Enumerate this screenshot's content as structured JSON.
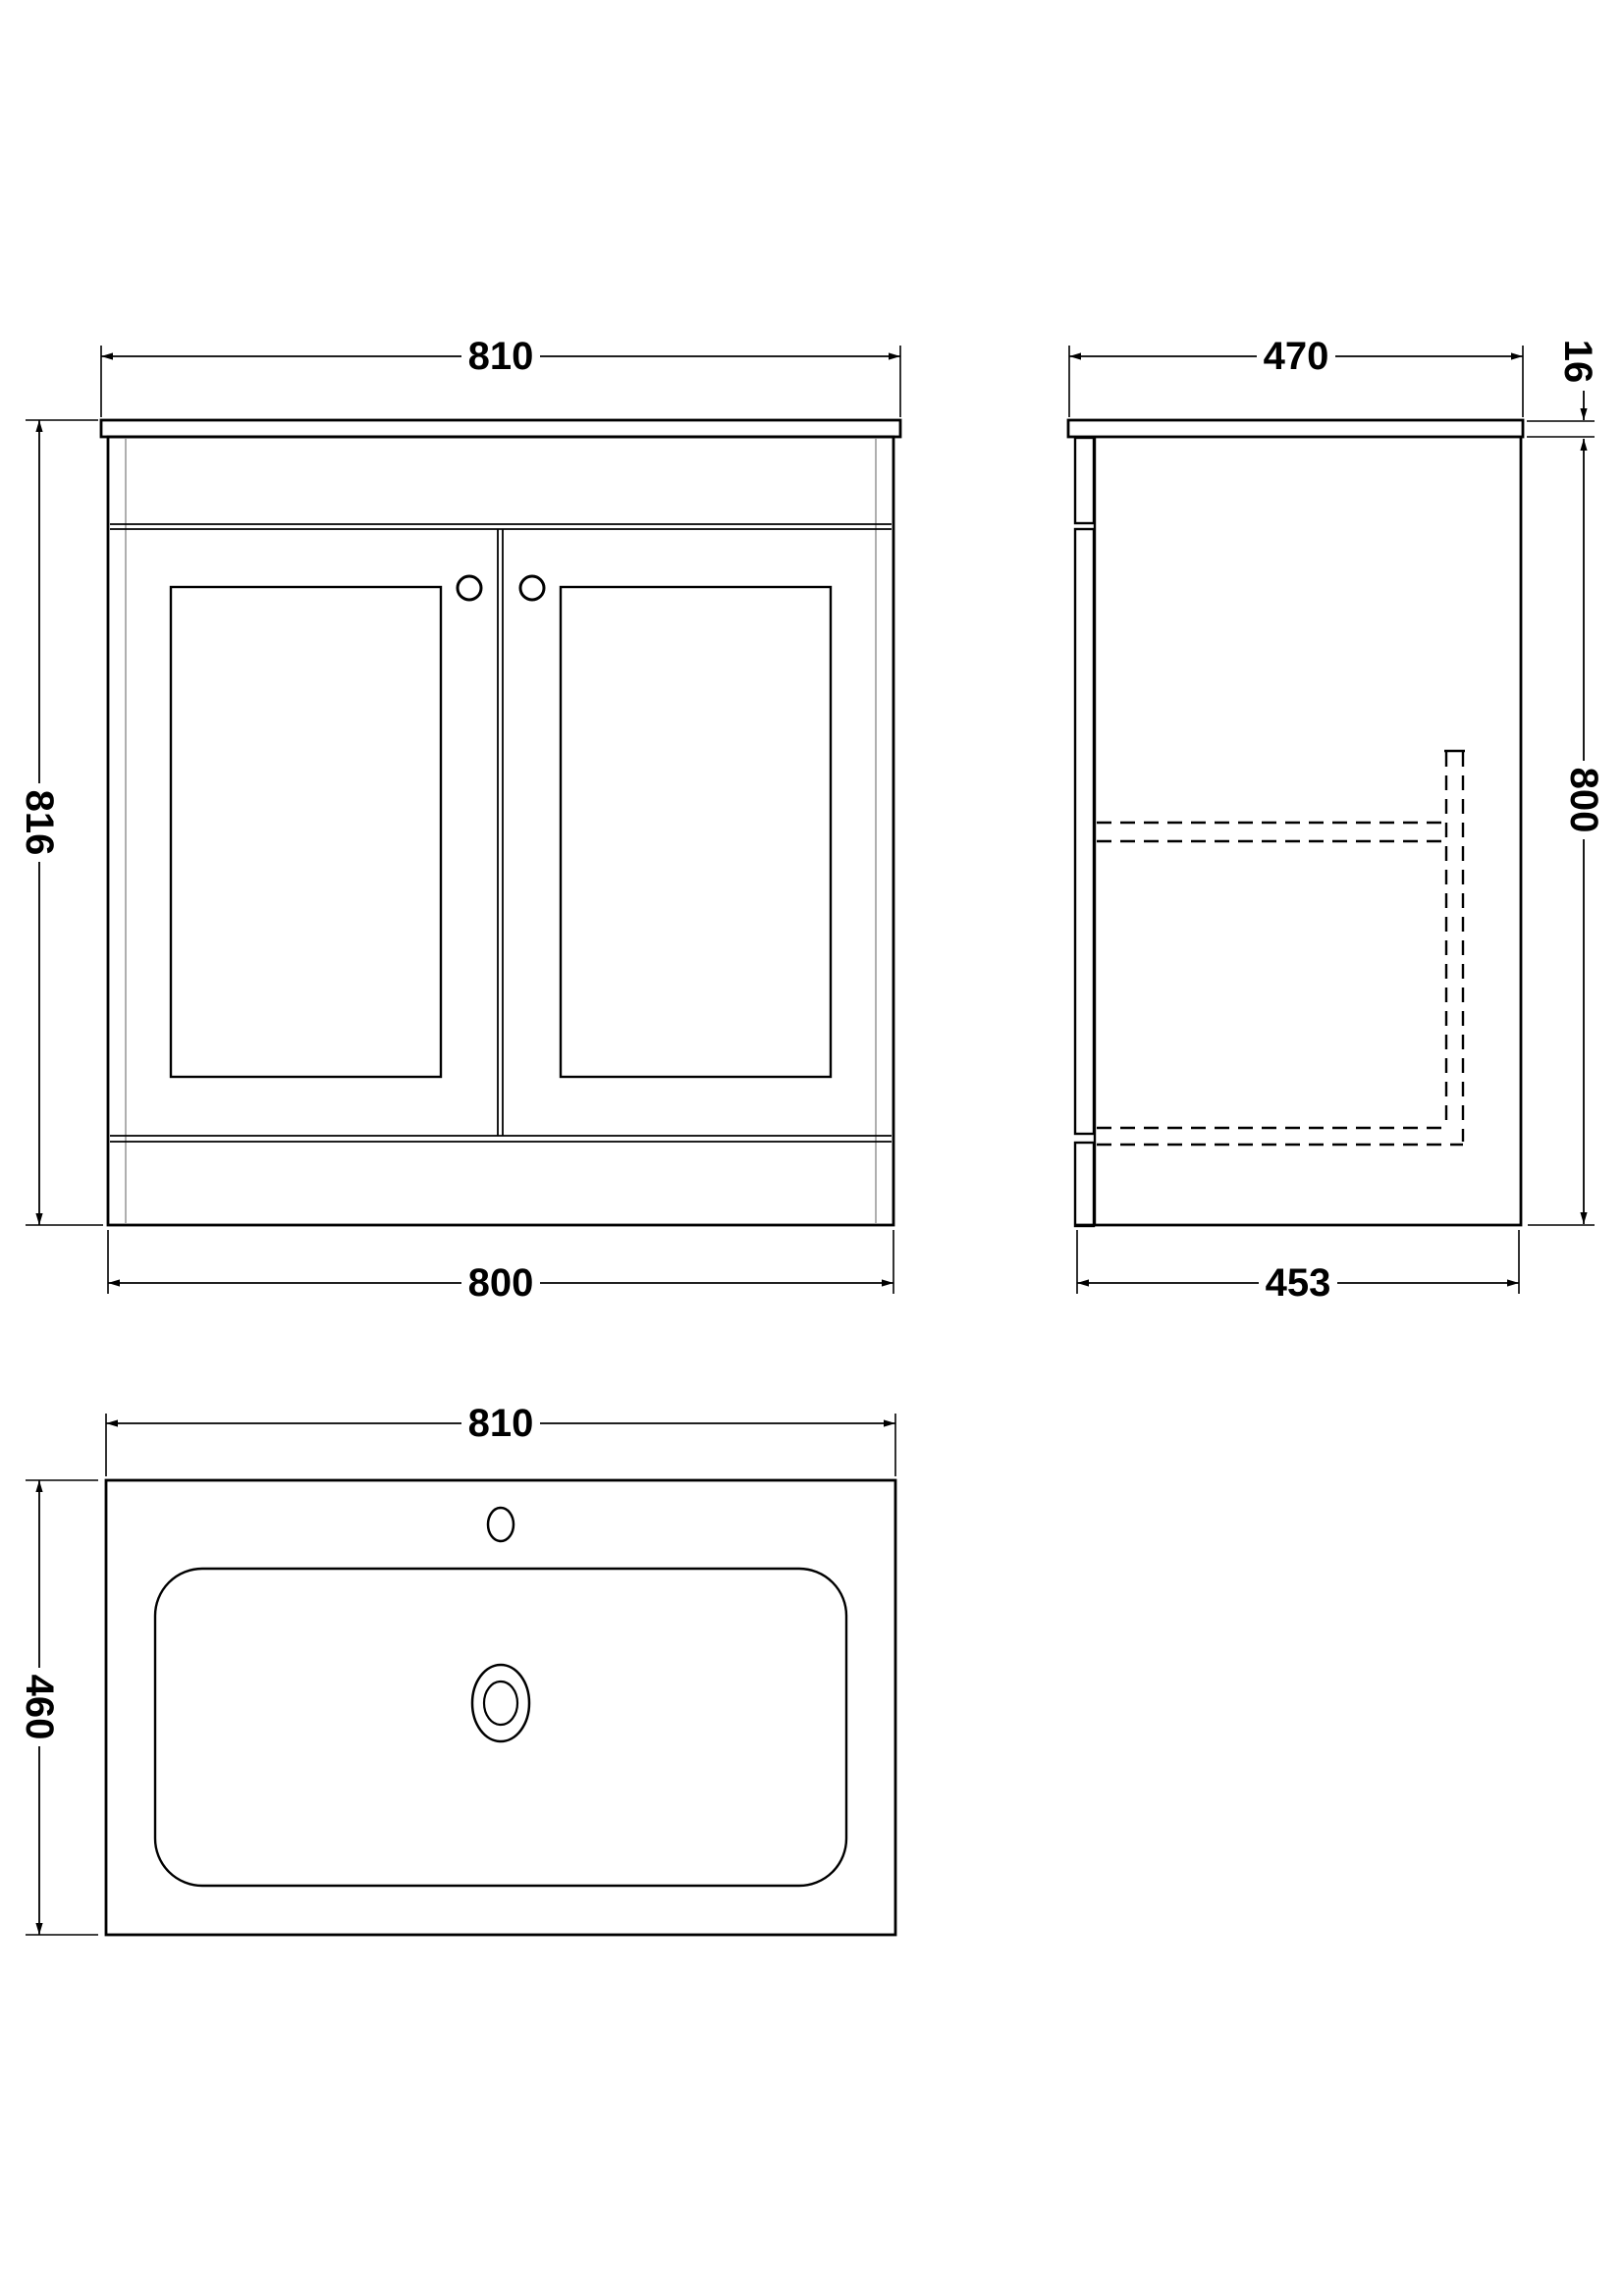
{
  "views": {
    "front": {
      "width_top": "810",
      "height": "816",
      "width_bottom": "800"
    },
    "side": {
      "depth_top": "470",
      "countertop_thickness": "16",
      "height": "800",
      "depth_bottom": "453"
    },
    "basin_plan": {
      "width": "810",
      "depth": "460"
    }
  },
  "colors": {
    "line": "#000000",
    "hidden_line": "#000000",
    "inner_panel_line": "#9b9b9b",
    "background": "#ffffff"
  }
}
